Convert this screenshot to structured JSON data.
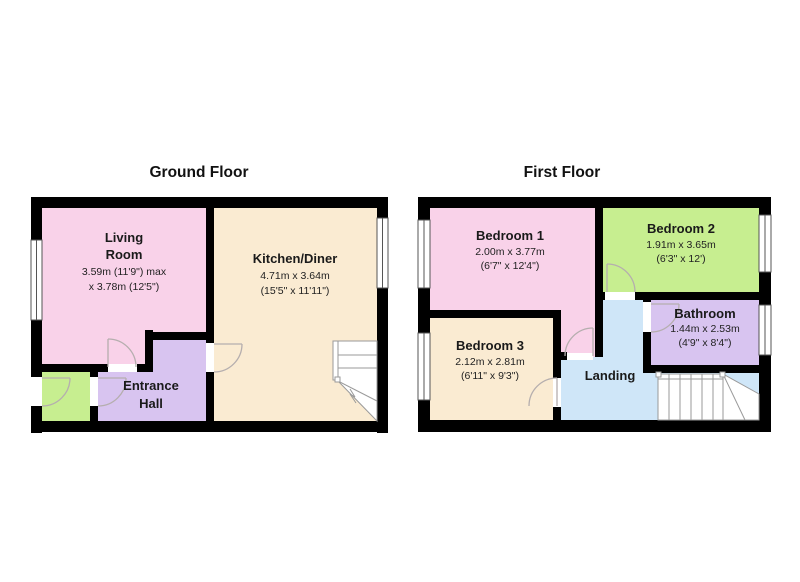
{
  "colors": {
    "wall": "#000000",
    "pink": "#f9d2e9",
    "cream": "#faebd2",
    "purple": "#d8c4f0",
    "green": "#c7ee90",
    "blue": "#cfe6f8",
    "door_arc": "#b5aeae",
    "stair_line": "#9a9a9a",
    "text": "#1a1a1a",
    "background": "#ffffff"
  },
  "ground_floor": {
    "title": "Ground Floor",
    "living_room": {
      "name_line1": "Living",
      "name_line2": "Room",
      "dims_line1": "3.59m (11'9\") max",
      "dims_line2": "x 3.78m (12'5\")"
    },
    "kitchen_diner": {
      "name": "Kitchen/Diner",
      "dims_line1": "4.71m x 3.64m",
      "dims_line2": "(15'5\" x 11'11\")"
    },
    "entrance_hall": {
      "name_line1": "Entrance",
      "name_line2": "Hall"
    }
  },
  "first_floor": {
    "title": "First Floor",
    "bedroom_1": {
      "name": "Bedroom 1",
      "dims_line1": "2.00m x 3.77m",
      "dims_line2": "(6'7\" x 12'4\")"
    },
    "bedroom_2": {
      "name": "Bedroom 2",
      "dims_line1": "1.91m x 3.65m",
      "dims_line2": "(6'3\" x 12')"
    },
    "bedroom_3": {
      "name": "Bedroom 3",
      "dims_line1": "2.12m x 2.81m",
      "dims_line2": "(6'11\" x 9'3\")"
    },
    "bathroom": {
      "name": "Bathroom",
      "dims_line1": "1.44m x 2.53m",
      "dims_line2": "(4'9\" x 8'4\")"
    },
    "landing": {
      "name": "Landing"
    }
  }
}
